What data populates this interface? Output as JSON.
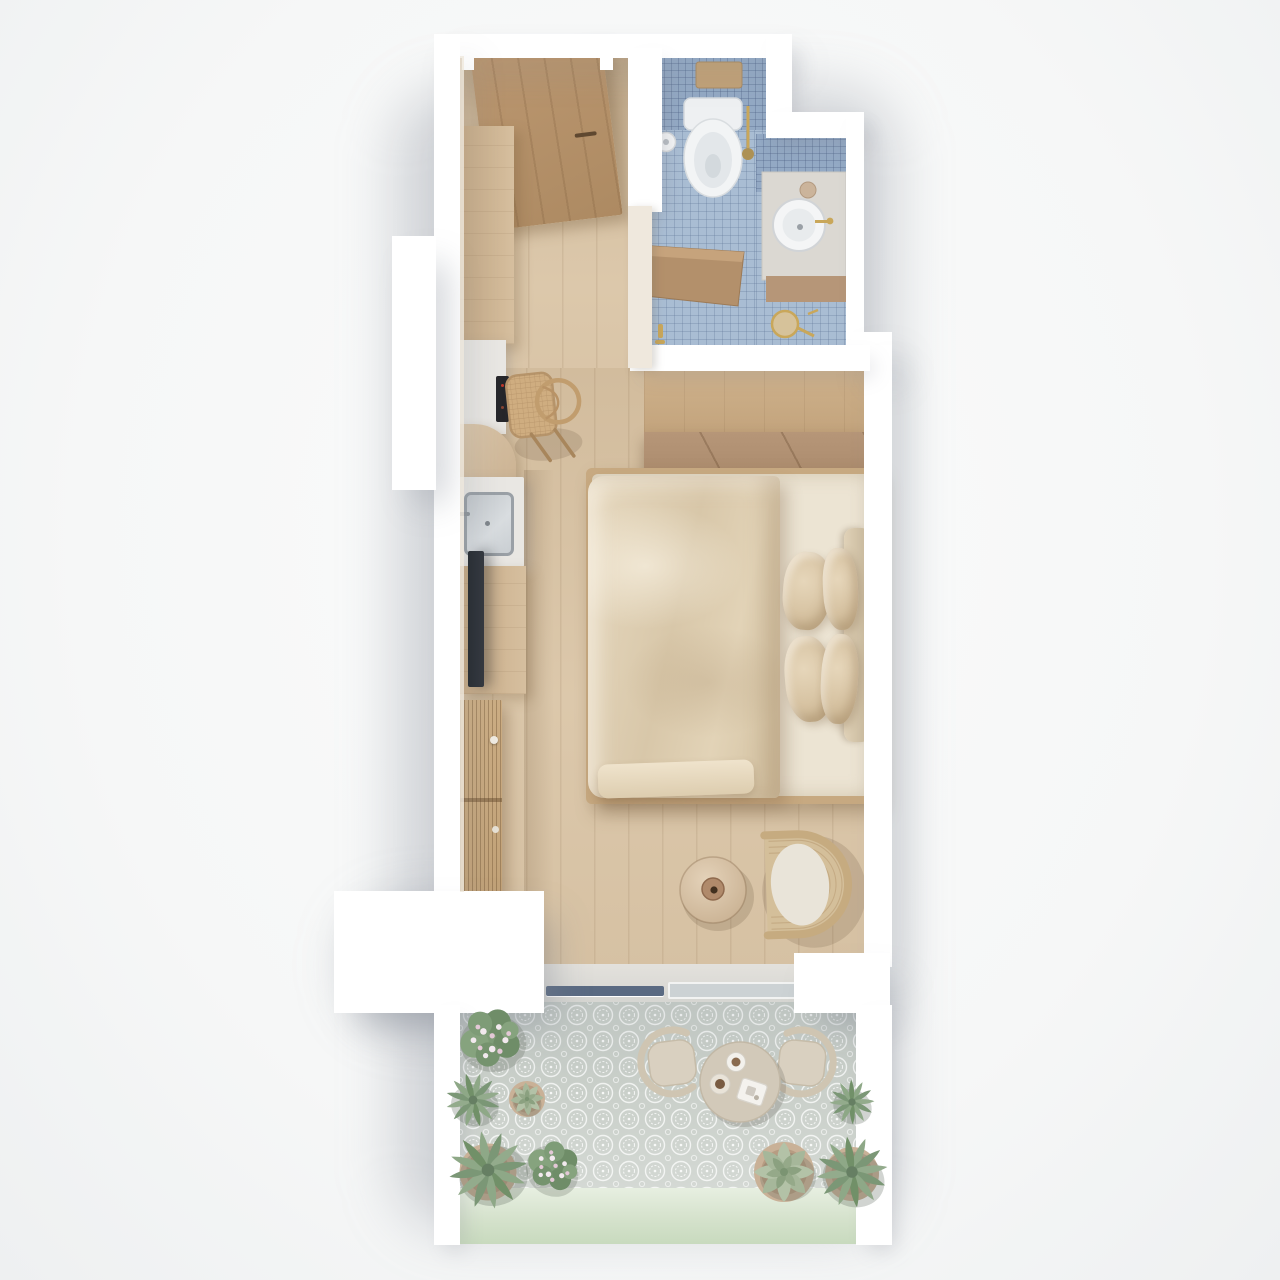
{
  "meta": {
    "description": "Top-down 3D architectural render of a narrow studio apartment with balcony",
    "view": "axonometric top view",
    "visible_text": "none"
  },
  "palette": {
    "bg": "#f6f7f7",
    "wall": "#ffffff",
    "cream-wall": "#efe8dd",
    "wood-floor": "#d8c3a6",
    "wood-door": "#b3906b",
    "wood-cabinet": "#cfb593",
    "wardrobe-top": "#c9aa84",
    "wardrobe-front": "#b19173",
    "wood-dark": "#a98c6f",
    "tile-blue": "#a9bdd3",
    "tile-blue-dark": "#93a9c4",
    "fixture-white": "#f0f1f2",
    "brass": "#c9a75a",
    "steel": "#9aa0a6",
    "counter-gray": "#e9e7e3",
    "tv-dark": "#31363d",
    "duvet": "#ddceb5",
    "pillow": "#d9c6a8",
    "mattress": "#ece4d3",
    "headboard": "#d8c9b0",
    "rattan": "#cdb188",
    "cushion": "#e9e4d9",
    "balcony-tile": "#c9cfc9",
    "mint": "#d5e2cc",
    "plant-green": "#8ea887",
    "plant-green-dark": "#7b9776",
    "plant-pale": "#b3c2a7",
    "flower-pink": "#e8d4de",
    "bistro-beige": "#d9d0c0",
    "glass-dark": "#5a6a82"
  },
  "rooms": {
    "entry_hall": {
      "label": "Entry hall",
      "floor": "light oak planks",
      "items": [
        "entrance-door",
        "tall-kitchen-cabinet",
        "control-panel",
        "cane-chair"
      ]
    },
    "bathroom": {
      "label": "Bathroom",
      "floor": "light blue mosaic tile",
      "items": [
        "wooden-flush-plate",
        "wall-hung-toilet",
        "toilet-paper-holder",
        "brass-toilet-brush",
        "vanity-counter",
        "round-vessel-sink",
        "brass-faucet",
        "vanity-vase",
        "wooden-door-leaf",
        "shower-drain",
        "brass-valves"
      ]
    },
    "kitchenette": {
      "label": "Kitchenette",
      "items": [
        "curved-cabinet",
        "counter-with-sink",
        "steel-sink",
        "faucet"
      ]
    },
    "bedroom_living": {
      "label": "Bedroom / living area",
      "items": [
        "wardrobe",
        "double-bed",
        "duvet",
        "pillows",
        "headboard",
        "nightstand-top",
        "nightstand-bottom",
        "vase-lamps",
        "wall-tv",
        "tv-console",
        "slatted-sideboard",
        "round-side-table",
        "table-vase",
        "rattan-armchair"
      ]
    },
    "balcony": {
      "label": "Balcony",
      "floor": "patterned encaustic tile",
      "parapet": "mint green ledge",
      "items": [
        "sliding-glass-door",
        "bistro-table",
        "two-cups",
        "serving-tray",
        "bistro-chair-left",
        "bistro-chair-right",
        "flower-bush",
        "agave-plants",
        "potted-succulents",
        "echeveria"
      ]
    }
  }
}
